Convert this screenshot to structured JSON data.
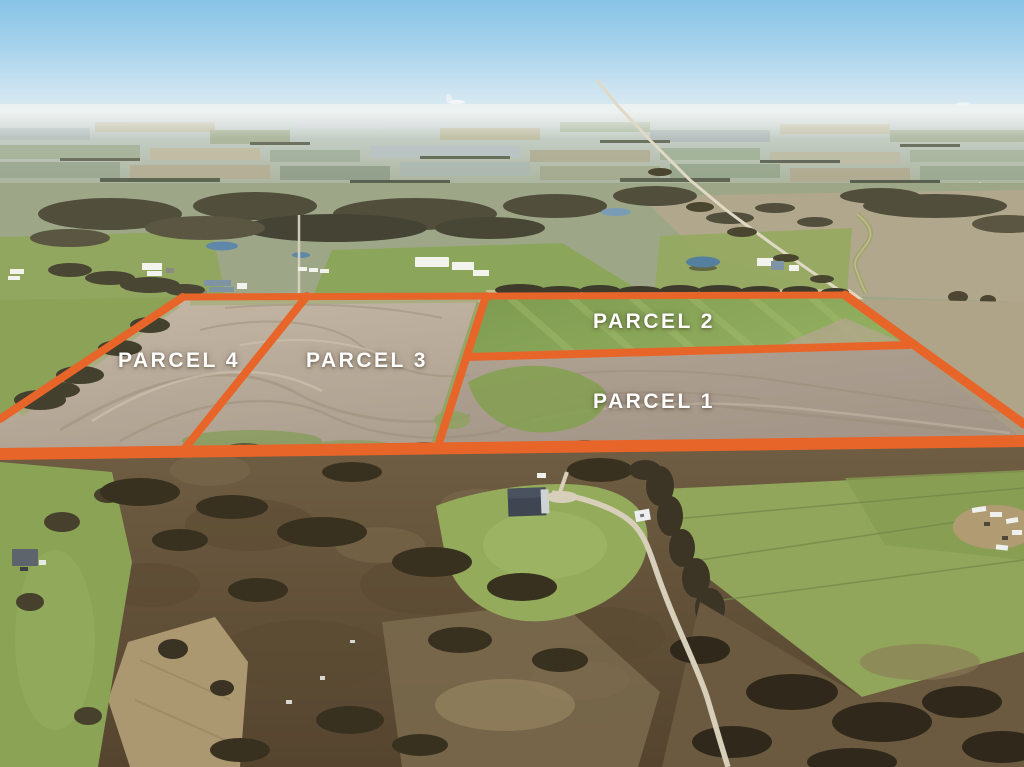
{
  "overlay": {
    "boundary_color": "#e8652a",
    "label_color": "#ffffff",
    "parcels": [
      {
        "id": "parcel-1",
        "label": "PARCEL 1"
      },
      {
        "id": "parcel-2",
        "label": "PARCEL 2"
      },
      {
        "id": "parcel-3",
        "label": "PARCEL 3"
      },
      {
        "id": "parcel-4",
        "label": "PARCEL 4"
      }
    ]
  },
  "scene": {
    "palette": {
      "sky_top": "#87c3e6",
      "sky_horizon": "#e9f0f2",
      "plowed_field": "#b9ab9b",
      "pasture_green": "#8ca45a",
      "scrub_brown": "#64523a",
      "tree_dark": "#3e3626",
      "road_tan": "#d8d1bf",
      "pond_blue": "#5f87a7"
    }
  }
}
